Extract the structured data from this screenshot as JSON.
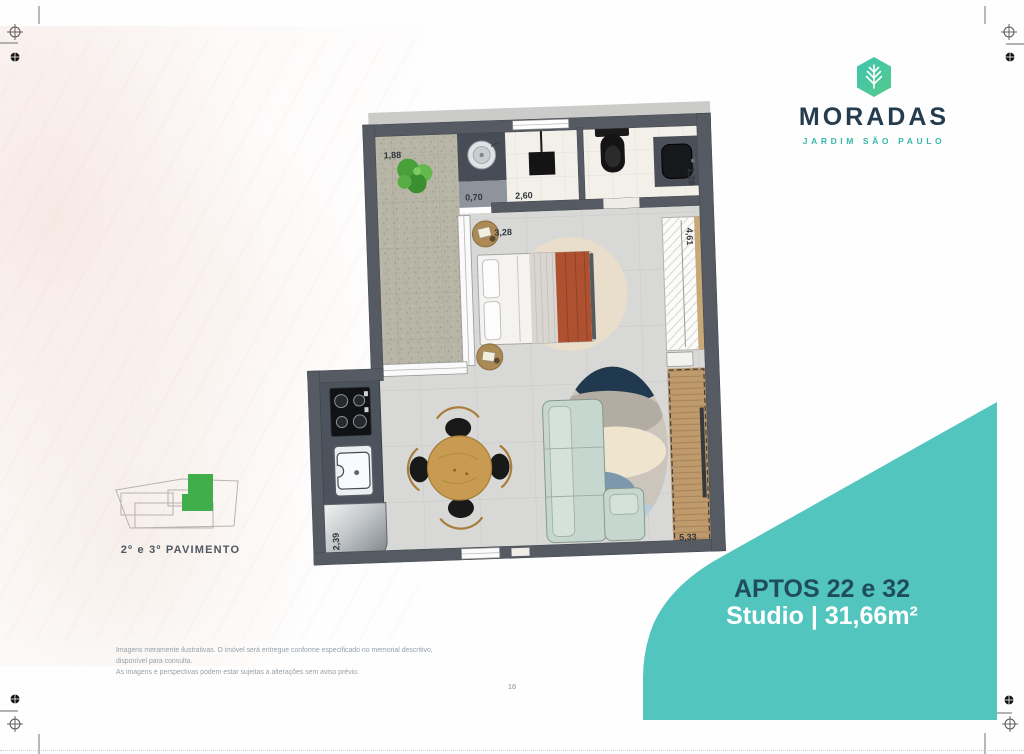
{
  "logo": {
    "brand": "MORADAS",
    "subtitle": "JARDIM SÃO PAULO"
  },
  "floor_plan": {
    "dimensions": {
      "terrace": "1,88",
      "service": "0,70",
      "shower": "2,60",
      "bathroom": "1,28",
      "bedroom": "3,28",
      "wardrobe": "4,61",
      "kitchen": "2,39",
      "balcony": "5,33"
    }
  },
  "key_plan": {
    "label": "2º e 3º PAVIMENTO"
  },
  "unit": {
    "title": "APTOS 22 e 32",
    "subtitle": "Studio | 31,66m²"
  },
  "disclaimer": {
    "line1": "Imagens meramente ilustrativas. O imóvel será entregue conforme especificado no memorial descritivo, disponível para consulta.",
    "line2": "As imagens e perspectivas podem estar sujeitas a alterações sem aviso prévio.",
    "page_number": "16"
  },
  "colors": {
    "accent_teal": "#53c5bf",
    "brand_navy": "#233c4e",
    "unit_title_navy": "#1f4d5c",
    "key_plan_green": "#3fae4b"
  }
}
